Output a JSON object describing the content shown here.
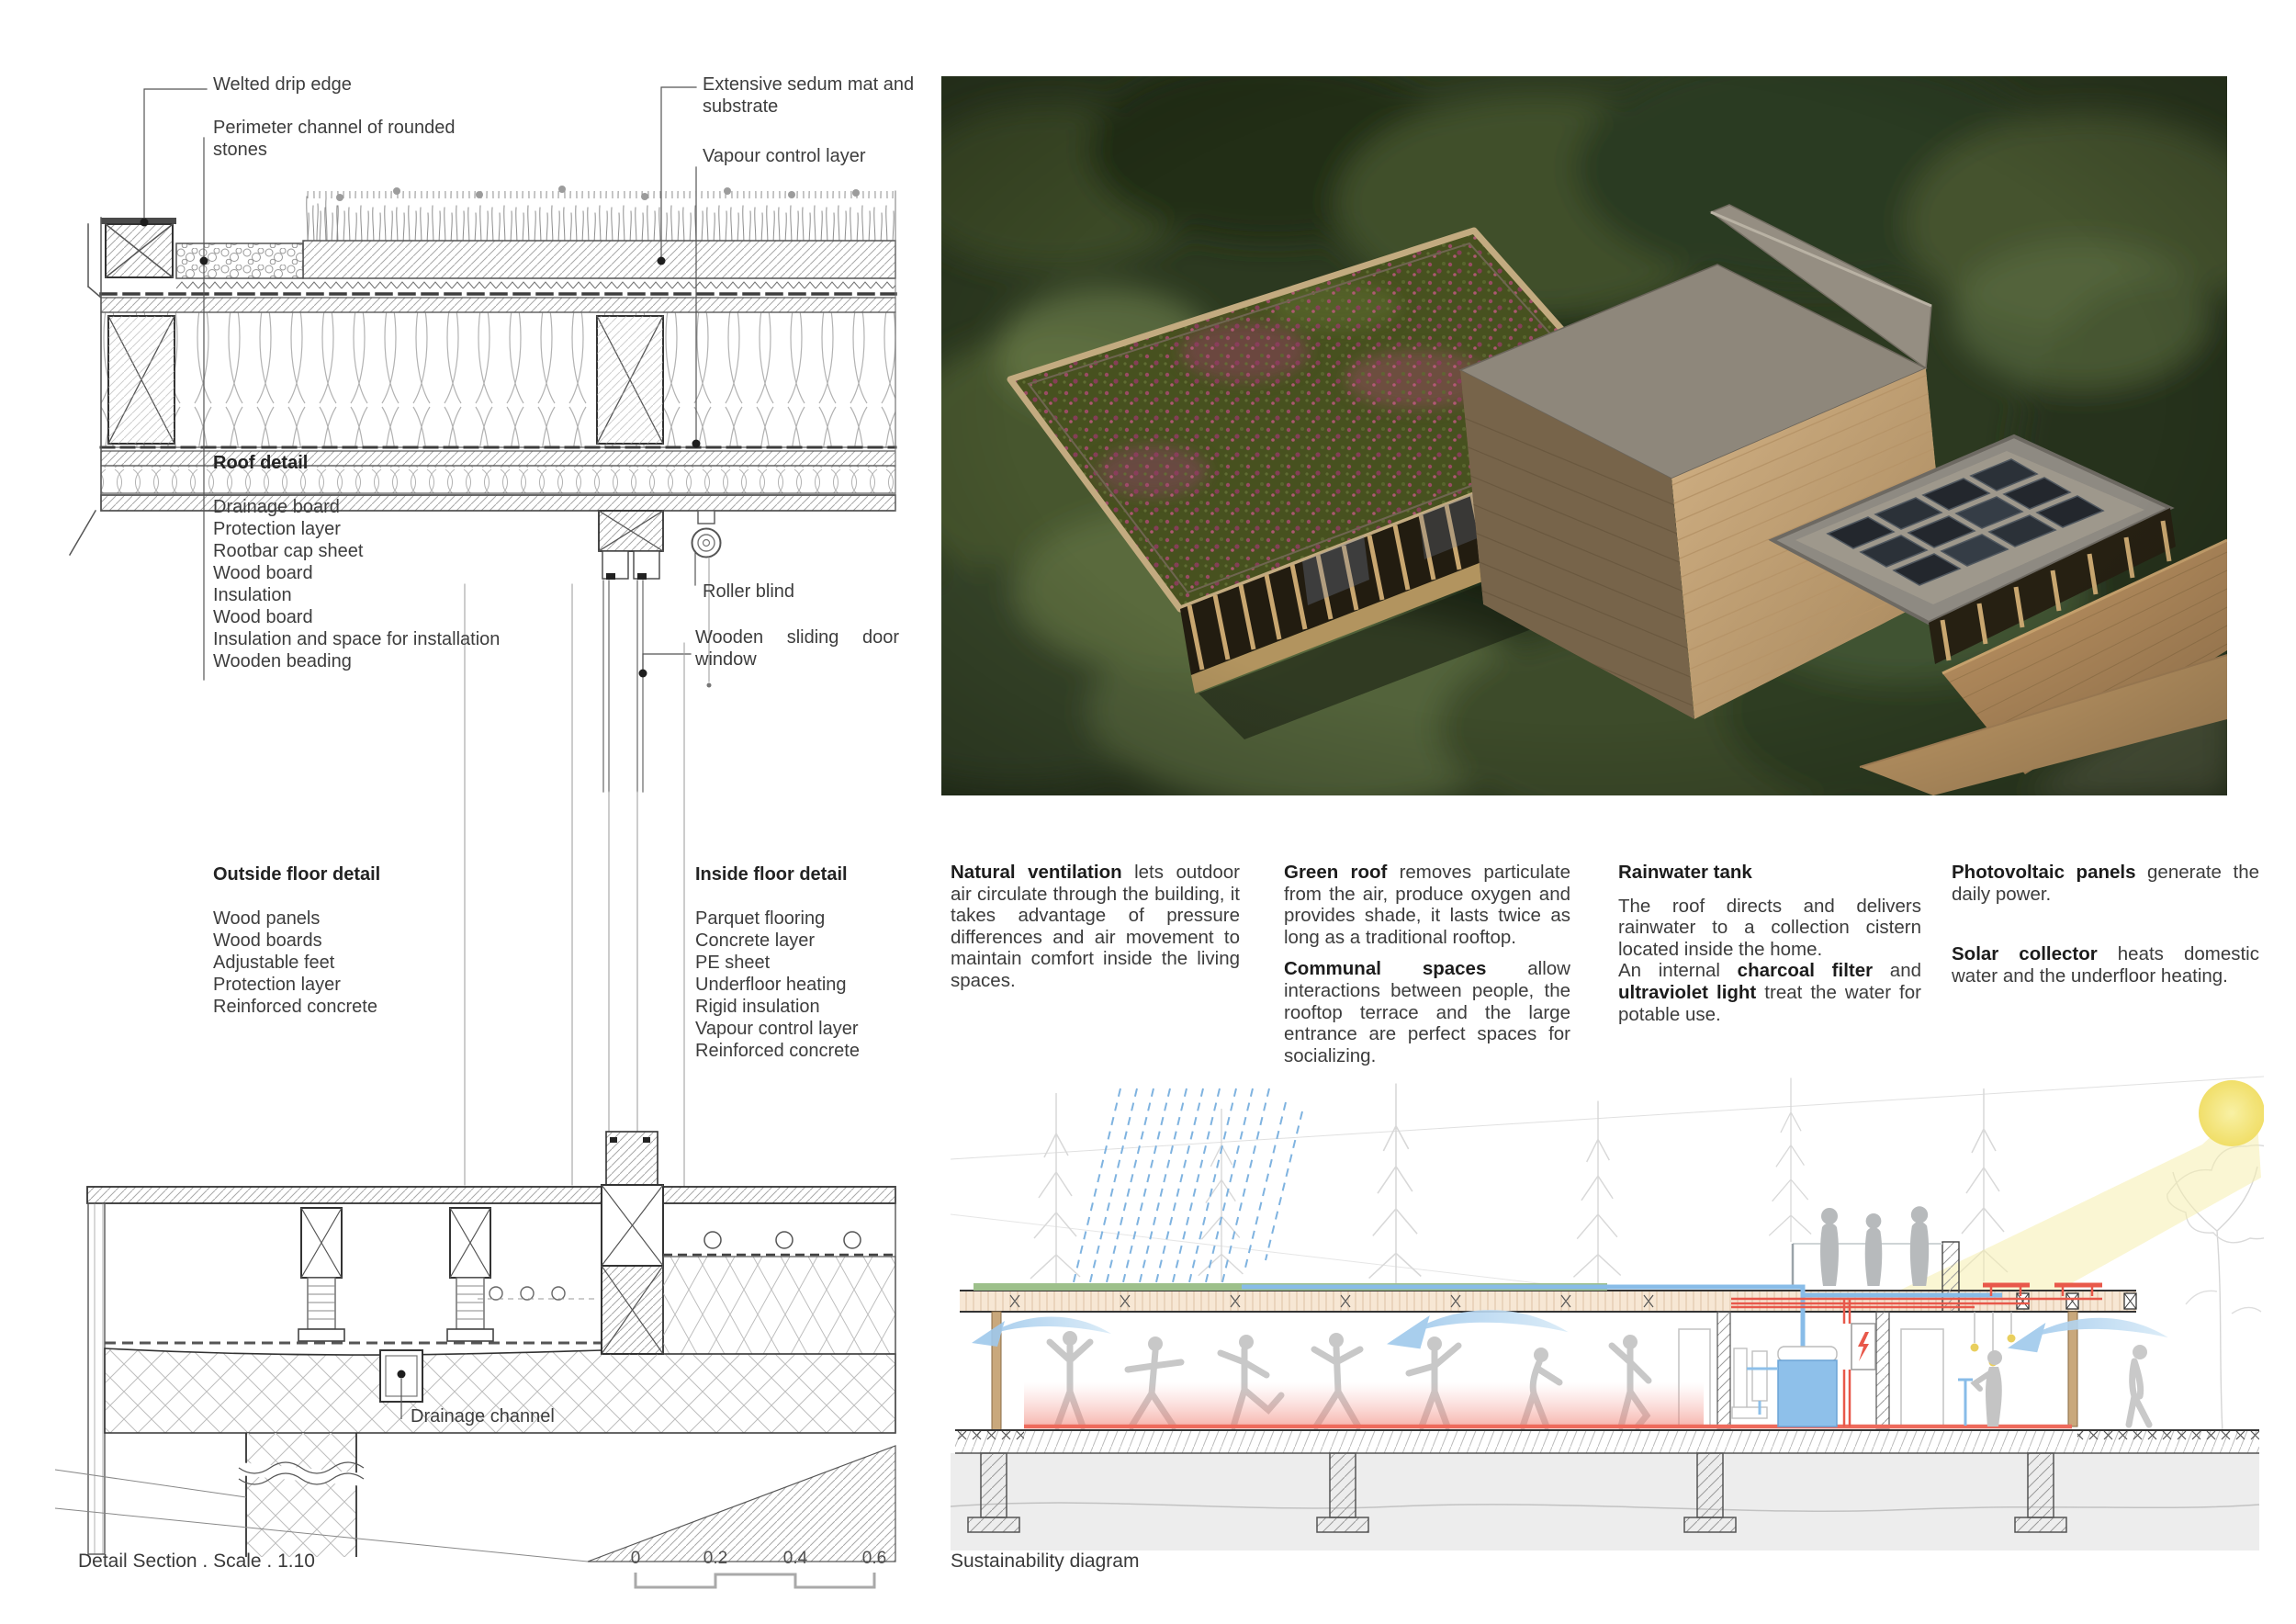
{
  "roof_detail": {
    "title": "Roof detail",
    "layers": [
      "Drainage board",
      "Protection layer",
      "Rootbar cap sheet",
      "Wood board",
      "Insulation",
      "Wood board",
      "Insulation and space for installation",
      "Wooden beading"
    ],
    "labels": {
      "welted_drip_edge": "Welted drip edge",
      "perimeter_channel": "Perimeter channel of rounded stones",
      "sedum_mat": "Extensive sedum mat and substrate",
      "vapour_control": "Vapour control layer",
      "roller_blind": "Roller blind",
      "sliding_window": "Wooden sliding door window"
    }
  },
  "floor_detail": {
    "outside": {
      "title": "Outside floor detail",
      "layers": [
        "Wood panels",
        "Wood boards",
        "Adjustable feet",
        "Protection layer",
        "Reinforced concrete"
      ]
    },
    "inside": {
      "title": "Inside floor detail",
      "layers": [
        "Parquet flooring",
        "Concrete layer",
        "PE sheet",
        "Underfloor heating",
        "Rigid insulation",
        "Vapour control layer",
        "Reinforced concrete"
      ]
    },
    "drainage_label": "Drainage channel"
  },
  "sustainability": {
    "caption": "Sustainability diagram",
    "columns": [
      {
        "paragraphs": [
          {
            "segments": [
              {
                "text": "Natural ventilation",
                "bold": true
              },
              {
                "text": " lets outdoor air circulate through the building, it takes advantage of pressure differences and air movement to maintain comfort inside the living spaces.",
                "bold": false
              }
            ]
          }
        ]
      },
      {
        "paragraphs": [
          {
            "segments": [
              {
                "text": "Green roof",
                "bold": true
              },
              {
                "text": " removes particulate from the air, produce oxygen and provides shade, it lasts twice as long as a traditional rooftop.",
                "bold": false
              }
            ]
          },
          {
            "segments": [
              {
                "text": "Communal spaces",
                "bold": true
              },
              {
                "text": " allow interactions between people, the rooftop terrace and the large entrance are perfect spaces for socializing.",
                "bold": false
              }
            ]
          }
        ]
      },
      {
        "heading": "Rainwater tank",
        "paragraphs": [
          {
            "segments": [
              {
                "text": "The roof directs and delivers rainwater to a collection cistern located inside the home.",
                "bold": false
              }
            ]
          },
          {
            "segments": [
              {
                "text": "An internal ",
                "bold": false
              },
              {
                "text": "charcoal filter",
                "bold": true
              },
              {
                "text": " and ",
                "bold": false
              },
              {
                "text": "ultraviolet light",
                "bold": true
              },
              {
                "text": " treat the water for potable use.",
                "bold": false
              }
            ]
          }
        ]
      },
      {
        "paragraphs": [
          {
            "segments": [
              {
                "text": "Photovoltaic panels",
                "bold": true
              },
              {
                "text": " generate the daily power.",
                "bold": false
              }
            ]
          },
          {
            "segments": [
              {
                "text": "Solar collector",
                "bold": true
              },
              {
                "text": " heats domestic water and the underfloor heating.",
                "bold": false
              }
            ]
          }
        ]
      }
    ]
  },
  "footer": {
    "left_caption": "Detail Section . Scale . 1.10",
    "scale_ticks": [
      "0",
      "0.2",
      "0.4",
      "0.6"
    ]
  },
  "colors": {
    "diagram_blue": "#7fb3e0",
    "diagram_red": "#e8584a",
    "diagram_green": "#9dc08b",
    "diagram_yellow": "#f3e67e",
    "drawing_line": "#444444"
  }
}
